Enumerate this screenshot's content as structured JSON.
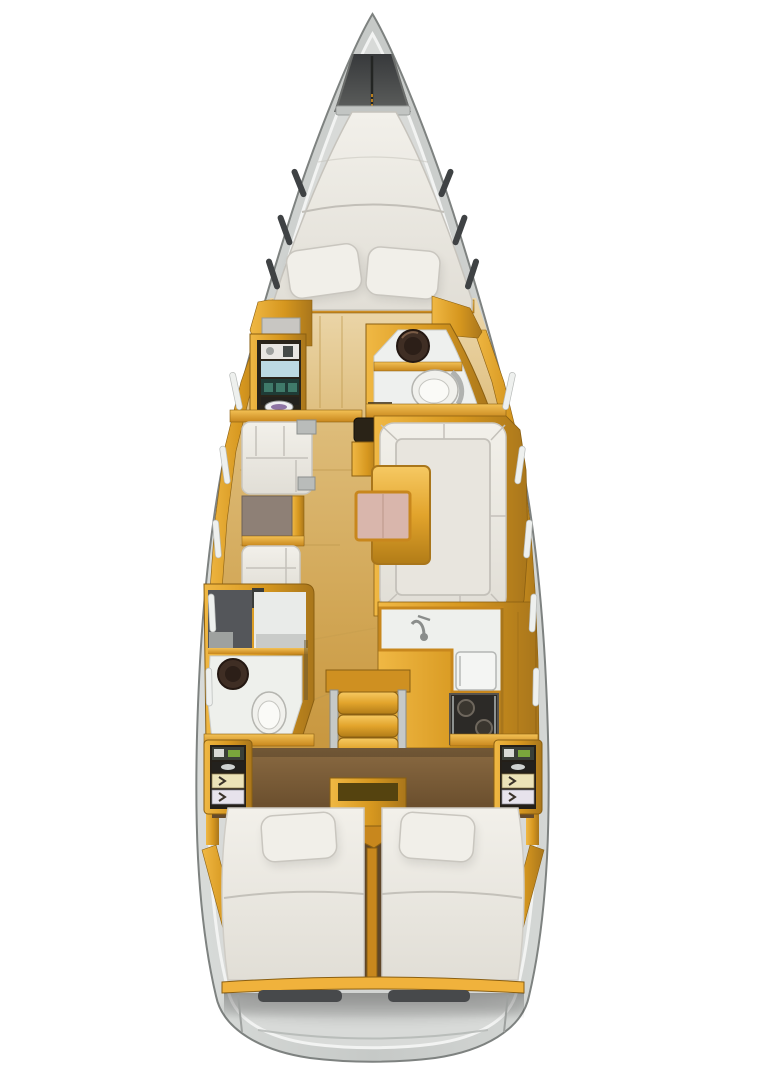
{
  "diagram": {
    "kind": "sailboat-interior-deck-plan",
    "orientation": "bow-up",
    "canvas": {
      "width": 762,
      "height": 1080
    }
  },
  "palette": {
    "hull_gray": "#cbcecc",
    "hull_edge": "#7e8280",
    "deck_band": "#eef0ee",
    "hull_inner": "#d8dad8",
    "anchor_dark": "#45474a",
    "cushion_white": "#edeae4",
    "cushion_seam": "#c4c1ba",
    "wood_mid": "#d9b26a",
    "aft_floor_brown": "#7c5c38",
    "amber": "#e4a42c",
    "amber_dark": "#a9761b",
    "taupe": "#8e8076",
    "table_pink": "#d9b6ac",
    "teal": "#3f7a6a",
    "shelf_dark": "#23211d",
    "shelf_blue": "#bcd9e2",
    "drawer_cream": "#ece3b8",
    "drawer_white": "#e7e3ec",
    "stove_black": "#2c2a27",
    "fixture_brown": "#3f2e24",
    "fixture_white": "#f1f1ed",
    "gray_panel": "#b9bcba",
    "window_slit_dark": "#3f4244",
    "window_slit_light": "#eef0ee"
  },
  "semantics": {
    "regions": [
      "hull",
      "anchor-locker",
      "v-berth",
      "wardrobe",
      "forward-head",
      "port-settee",
      "chart-table",
      "salon-table",
      "starboard-u-settee",
      "aft-head",
      "galley",
      "companionway-steps",
      "engine-box",
      "aft-cabin-port",
      "aft-cabin-starboard",
      "storage-locker-port",
      "storage-locker-starboard",
      "stern-beam",
      "stern-hatches"
    ]
  }
}
